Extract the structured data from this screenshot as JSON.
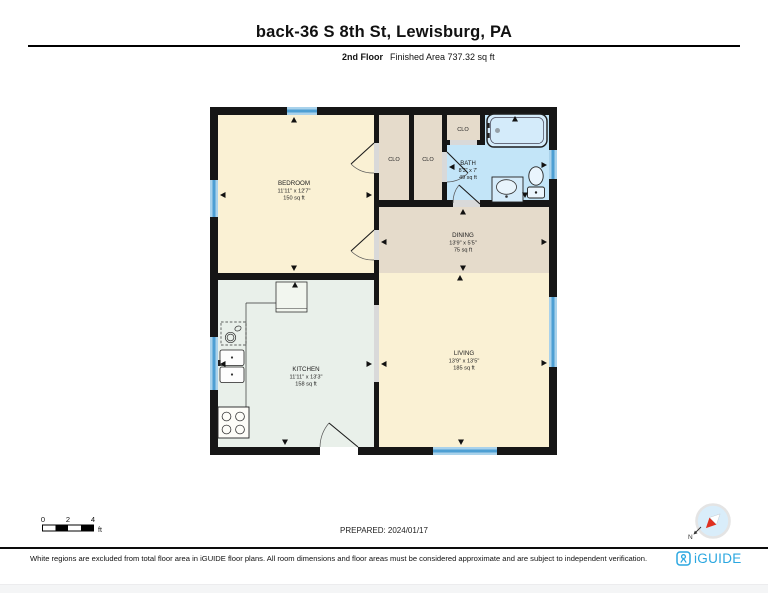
{
  "header": {
    "title": "back-36 S 8th St, Lewisburg, PA",
    "floor_label": "2nd Floor",
    "finished_area": "Finished Area 737.32 sq ft"
  },
  "floorplan": {
    "rooms": {
      "bedroom": {
        "name": "BEDROOM",
        "dims": "11'11\" x 12'7\"",
        "area": "150 sq ft"
      },
      "kitchen": {
        "name": "KITCHEN",
        "dims": "11'11\" x 13'3\"",
        "area": "158 sq ft"
      },
      "dining": {
        "name": "DINING",
        "dims": "13'9\" x 5'5\"",
        "area": "75 sq ft"
      },
      "living": {
        "name": "LIVING",
        "dims": "13'9\" x 13'5\"",
        "area": "185 sq ft"
      },
      "bath": {
        "name": "BATH",
        "dims": "8'3\" x 7'",
        "area": "49 sq ft"
      },
      "closet_bedroom": {
        "name": "CLO"
      },
      "closet_hall": {
        "name": "CLO"
      },
      "closet_bath": {
        "name": "CLO"
      }
    },
    "colors": {
      "wall": "#161616",
      "room_cream": "#faf1d4",
      "room_tan": "#e5dbcb",
      "room_mint": "#e9f0ea",
      "room_bath_blue": "#c3e5f8",
      "window_blue": "#4d9fd3",
      "opening_gray": "#d9d9d9"
    }
  },
  "scale_bar": {
    "tick_0": "0",
    "tick_2": "2",
    "tick_4": "4",
    "unit": "ft"
  },
  "prepared_label": "PREPARED: 2024/01/17",
  "compass": {
    "north_label": "N"
  },
  "footer": {
    "disclaimer": "White regions are excluded from total floor area in iGUIDE floor plans. All room dimensions and floor areas must be considered approximate and are subject to independent verification.",
    "brand": "iGUIDE"
  }
}
